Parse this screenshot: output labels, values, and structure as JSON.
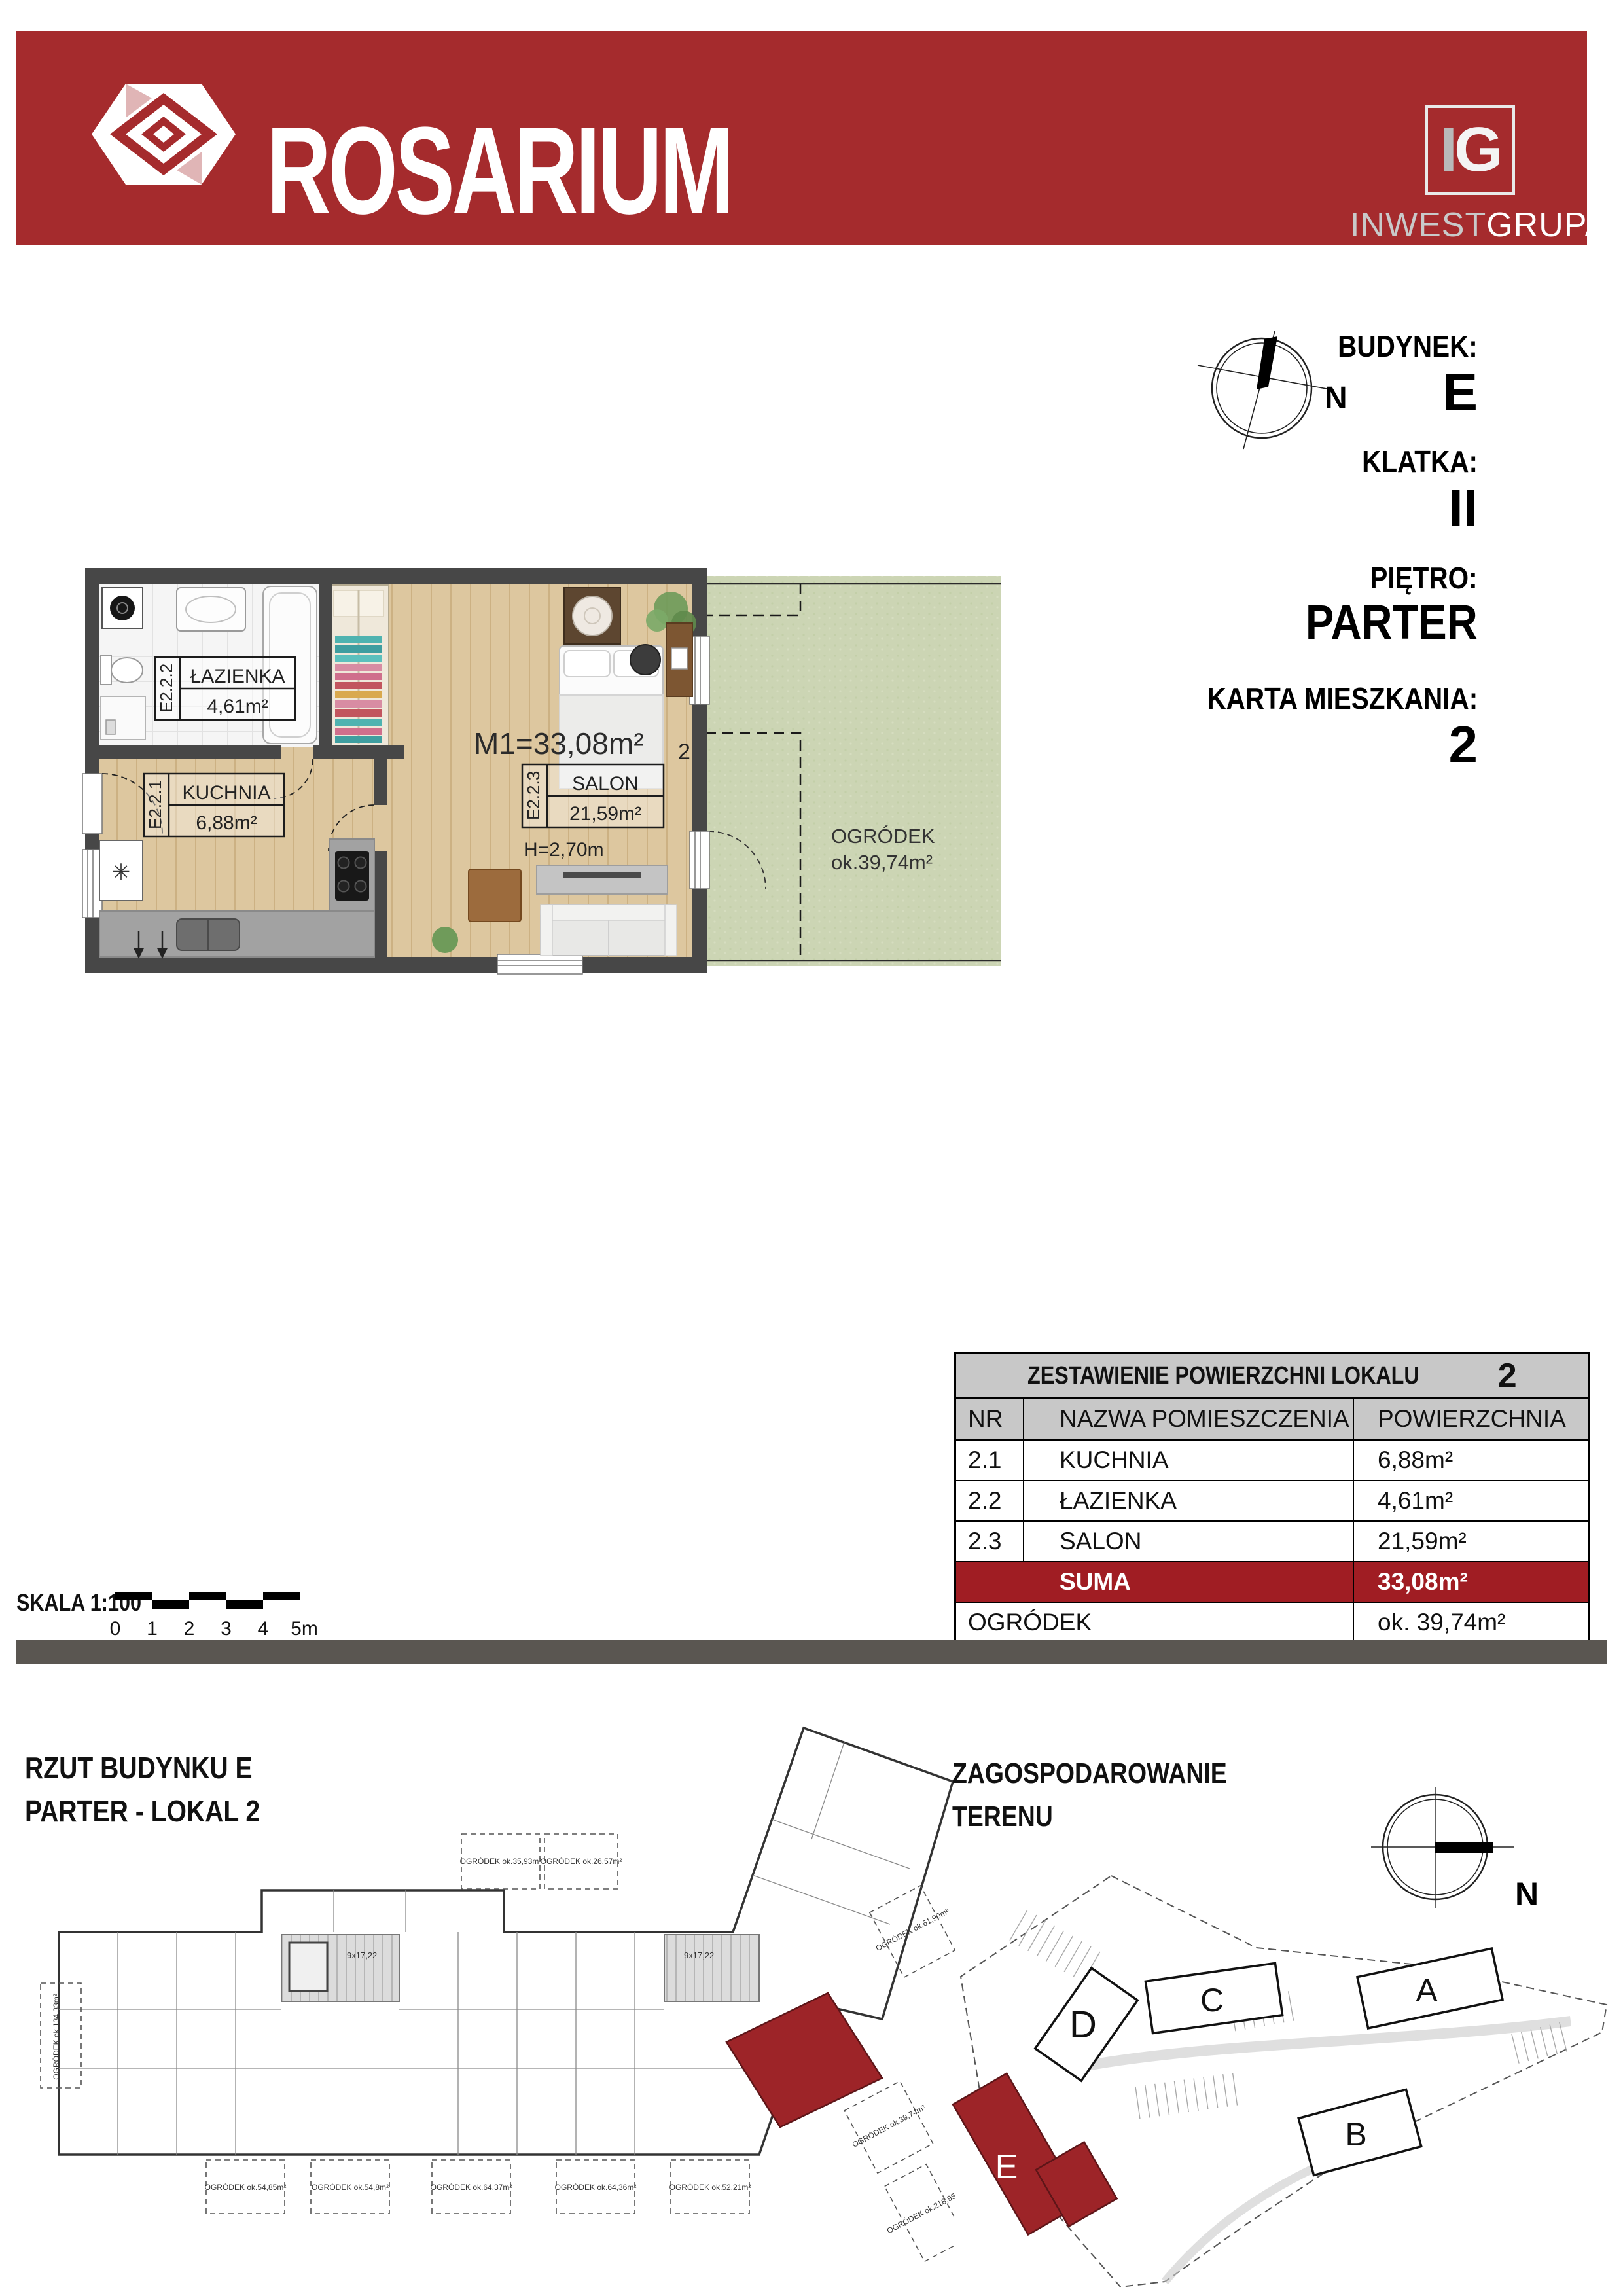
{
  "header": {
    "brand": "ROSARIUM",
    "logo_i": "I",
    "logo_g": "G",
    "company_part1": "INWEST",
    "company_part2": "GRUPA"
  },
  "info_panel": {
    "building_label": "BUDYNEK:",
    "building": "E",
    "staircase_label": "KLATKA:",
    "staircase": "II",
    "floor_label": "PIĘTRO:",
    "floor": "PARTER",
    "card_label": "KARTA MIESZKANIA:",
    "card": "2",
    "compass_n": "N"
  },
  "floor_plan": {
    "total": "M1=33,08m²",
    "ceiling_height": "H=2,70m",
    "unit_number": "2",
    "rooms": [
      {
        "code": "E2.2.1",
        "name": "KUCHNIA",
        "area": "6,88m²"
      },
      {
        "code": "E2.2.2",
        "name": "ŁAZIENKA",
        "area": "4,61m²"
      },
      {
        "code": "E2.2.3",
        "name": "SALON",
        "area": "21,59m²"
      }
    ],
    "garden_name": "OGRÓDEK",
    "garden_area": "ok.39,74m²",
    "freezer_symbol": "✳"
  },
  "table": {
    "title": "ZESTAWIENIE POWIERZCHNI LOKALU",
    "title_number": "2",
    "col_nr": "NR",
    "col_name": "NAZWA POMIESZCZENIA",
    "col_area": "POWIERZCHNIA",
    "rows": [
      {
        "nr": "2.1",
        "name": "KUCHNIA",
        "area": "6,88m²"
      },
      {
        "nr": "2.2",
        "name": "ŁAZIENKA",
        "area": "4,61m²"
      },
      {
        "nr": "2.3",
        "name": "SALON",
        "area": "21,59m²"
      }
    ],
    "suma_label": "SUMA",
    "suma_area": "33,08m²",
    "garden_label": "OGRÓDEK",
    "garden_area": "ok. 39,74m²"
  },
  "scale": {
    "label": "SKALA 1:100",
    "ticks": [
      "0",
      "1",
      "2",
      "3",
      "4",
      "5m"
    ]
  },
  "building_plan": {
    "title_line1": "RZUT BUDYNKU E",
    "title_line2": "PARTER - LOKAL 2",
    "stair_note": "9x17,22",
    "garden_labels": [
      "OGRÓDEK ok.134,33m²",
      "OGRÓDEK ok.35,93m²",
      "OGRÓDEK ok.26,57m²",
      "OGRÓDEK ok.54,85m²",
      "OGRÓDEK ok.54,8m²",
      "OGRÓDEK ok.64,37m²",
      "OGRÓDEK ok.64,36m²",
      "OGRÓDEK ok.52,21m²",
      "OGRÓDEK ok.61,90m²",
      "OGRÓDEK ok.39,74m²",
      "OGRÓDEK ok.218,95m²"
    ]
  },
  "site_plan": {
    "title_line1": "ZAGOSPODAROWANIE",
    "title_line2": "TERENU",
    "compass_n": "N",
    "buildings": [
      "D",
      "C",
      "A",
      "B",
      "E"
    ]
  },
  "colors": {
    "accent_red": "#A52B2D",
    "suma_red": "#A01D23",
    "unit_red": "#9D2428",
    "divider_gray": "#5a5651",
    "header_gray": "#c8c8c8",
    "wall_gray": "#474747",
    "wood": "#ddc79f",
    "garden_green": "#ccd5b4"
  }
}
